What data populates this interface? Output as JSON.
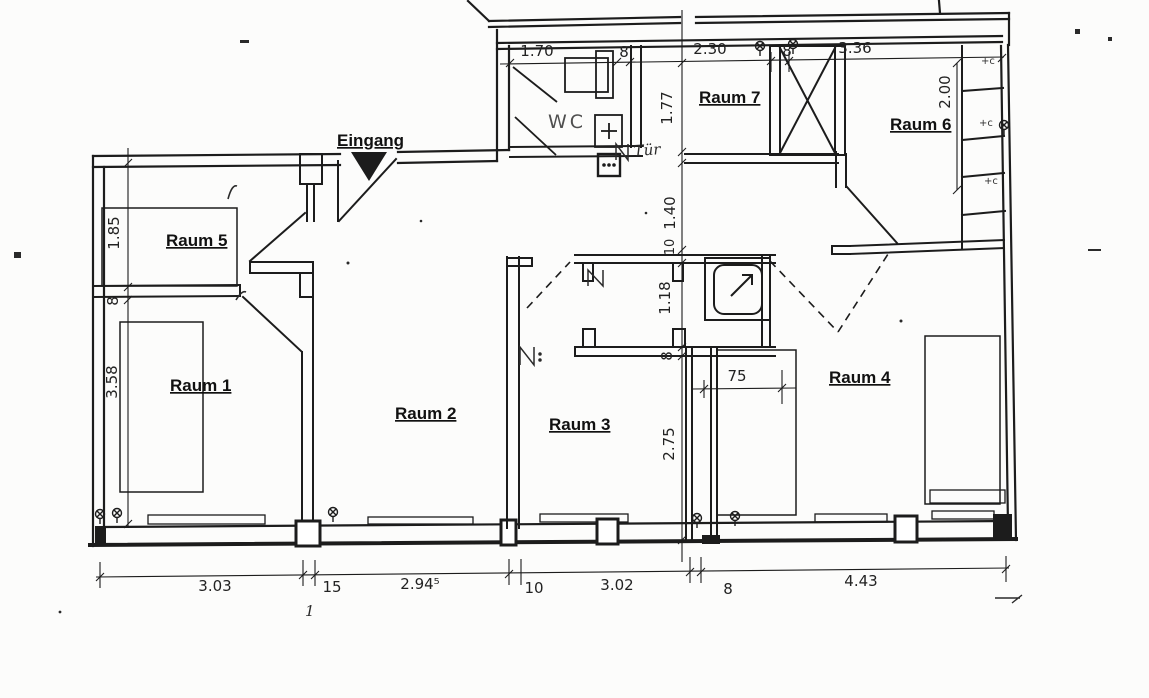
{
  "drawing": {
    "type": "floor-plan",
    "language": "de"
  },
  "rooms": {
    "r1": "Raum 1",
    "r2": "Raum 2",
    "r3": "Raum 3",
    "r4": "Raum 4",
    "r5": "Raum 5",
    "r6": "Raum 6",
    "r7": "Raum 7",
    "wc": "WC"
  },
  "annotations": {
    "entrance": "Eingang",
    "door_note": "Tür",
    "sheet_mark": "1",
    "duct_marks": [
      "+c",
      "+c",
      "+c"
    ]
  },
  "dimensions": {
    "top": [
      "1.70",
      "8",
      "2.30",
      "8",
      "3.36"
    ],
    "right": [
      "2.00"
    ],
    "left": [
      "1.85",
      "8",
      "3.58"
    ],
    "center": [
      "1.77",
      "1.40",
      "10",
      "1.18",
      "8",
      "2.75"
    ],
    "closet": "75",
    "bottom": [
      "3.03",
      "15",
      "2.94⁵",
      "10",
      "3.02",
      "8",
      "4.43"
    ]
  },
  "colors": {
    "ink": "#1c1c1c",
    "paper": "#fcfcfb"
  }
}
